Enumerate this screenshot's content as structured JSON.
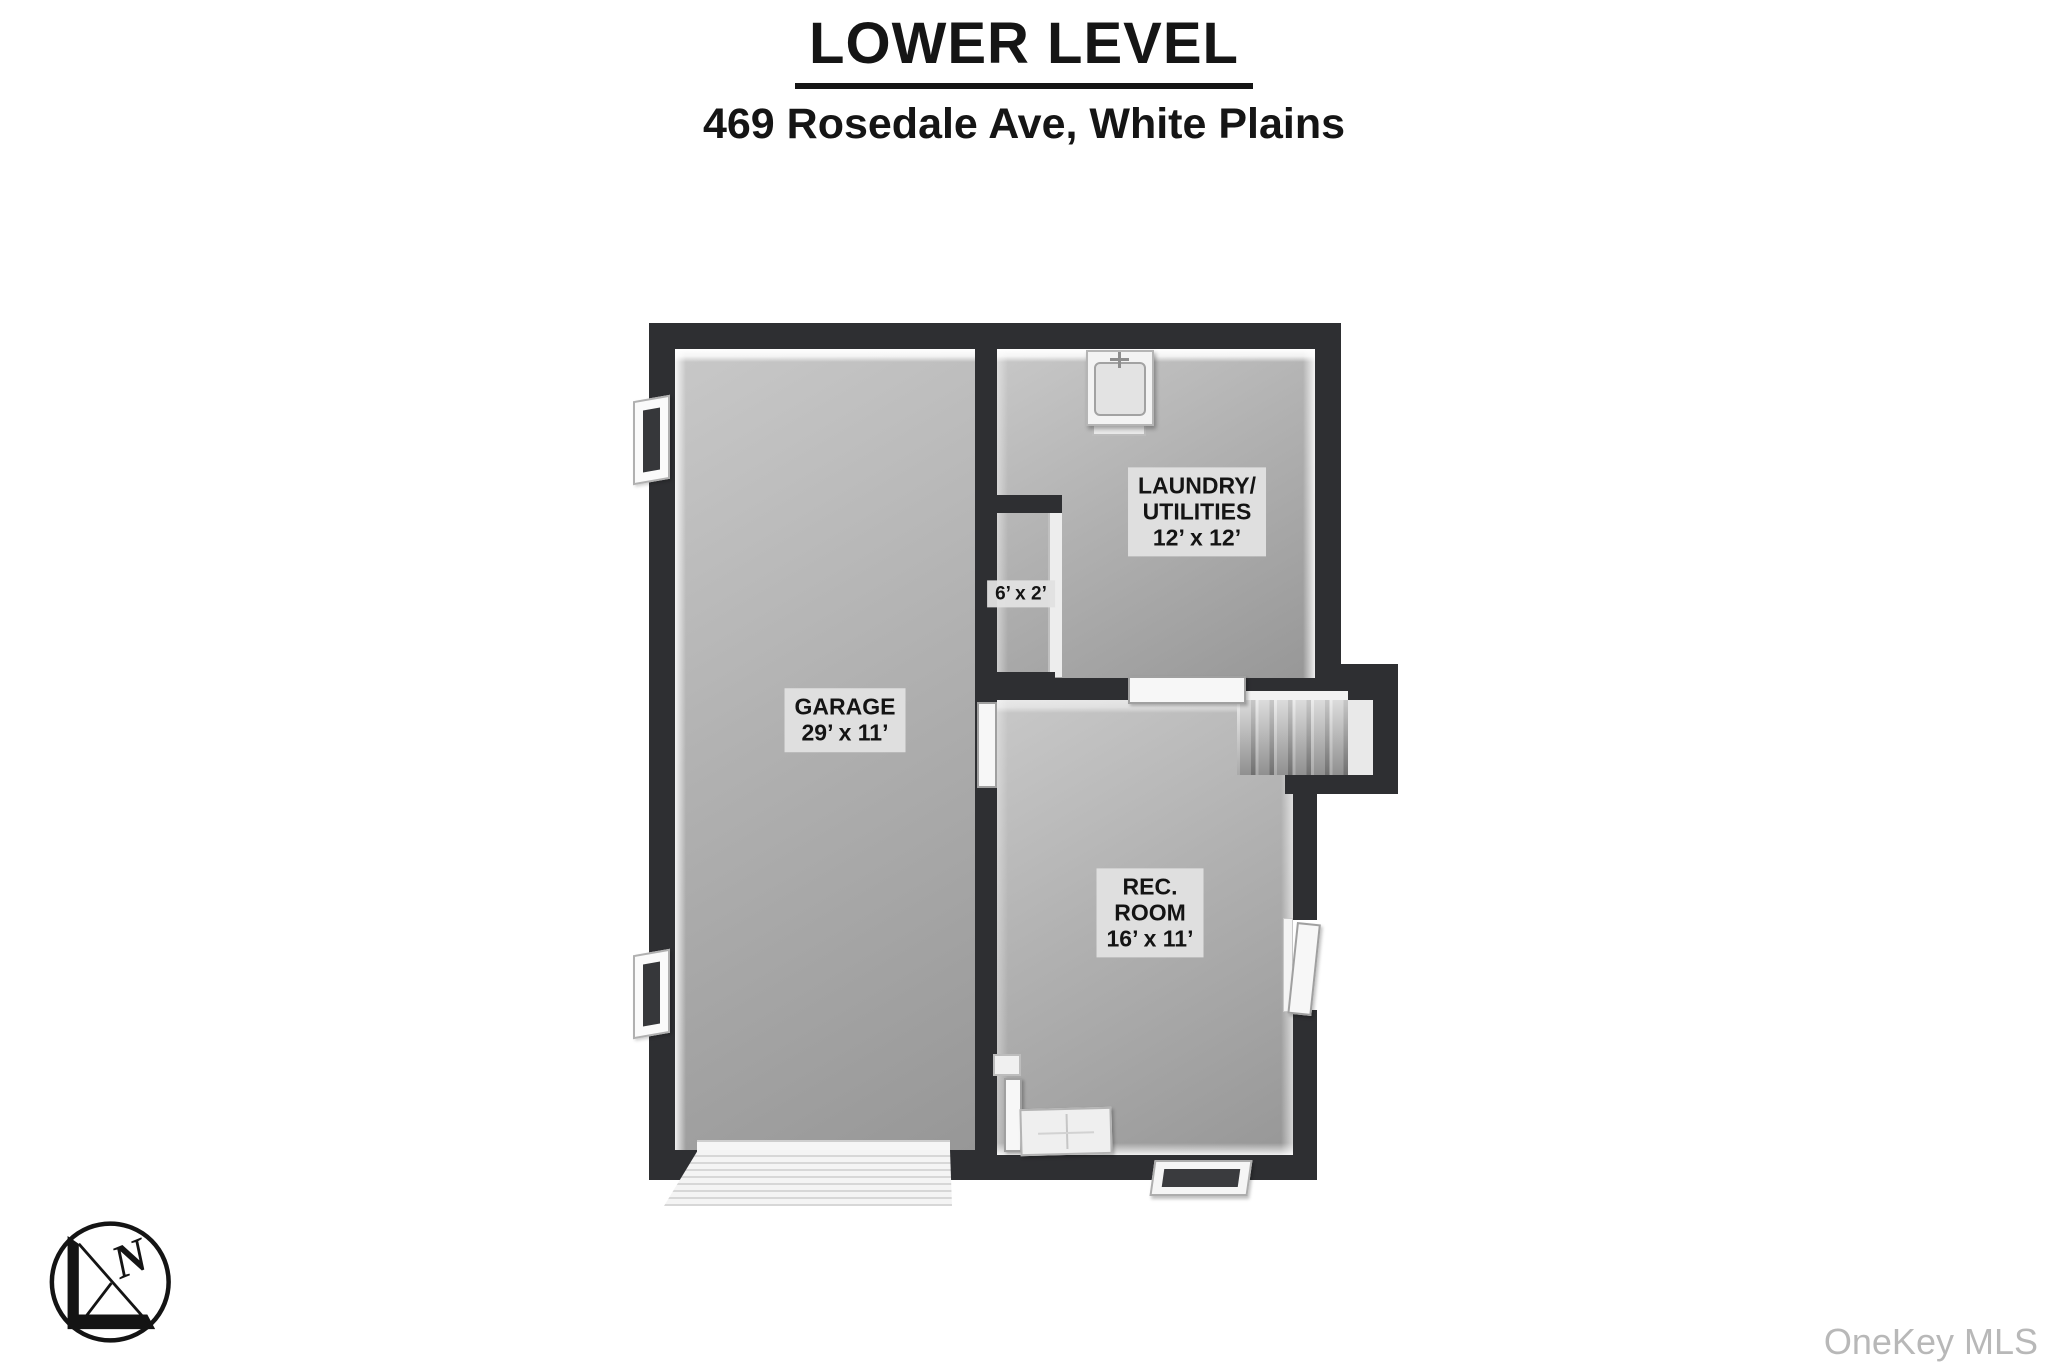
{
  "header": {
    "title": "LOWER LEVEL",
    "subtitle": "469 Rosedale Ave, White Plains"
  },
  "rooms": {
    "garage": {
      "line1": "GARAGE",
      "line2": "29’ x 11’"
    },
    "laundry": {
      "line1": "LAUNDRY/",
      "line2": "UTILITIES",
      "line3": "12’ x 12’"
    },
    "closet": {
      "line1": "6’ x 2’"
    },
    "rec_room": {
      "line1": "REC.",
      "line2": "ROOM",
      "line3": "16’ x 11’"
    }
  },
  "compass": {
    "north_label": "N"
  },
  "footer": {
    "watermark": "OneKey MLS"
  },
  "colors": {
    "background": "#ffffff",
    "wall": "#2e2f32",
    "floor_light": "#c8c8c8",
    "floor_dark": "#979797",
    "label_bg": "#e1e1e1",
    "watermark_gray": "#b8b8b8"
  }
}
